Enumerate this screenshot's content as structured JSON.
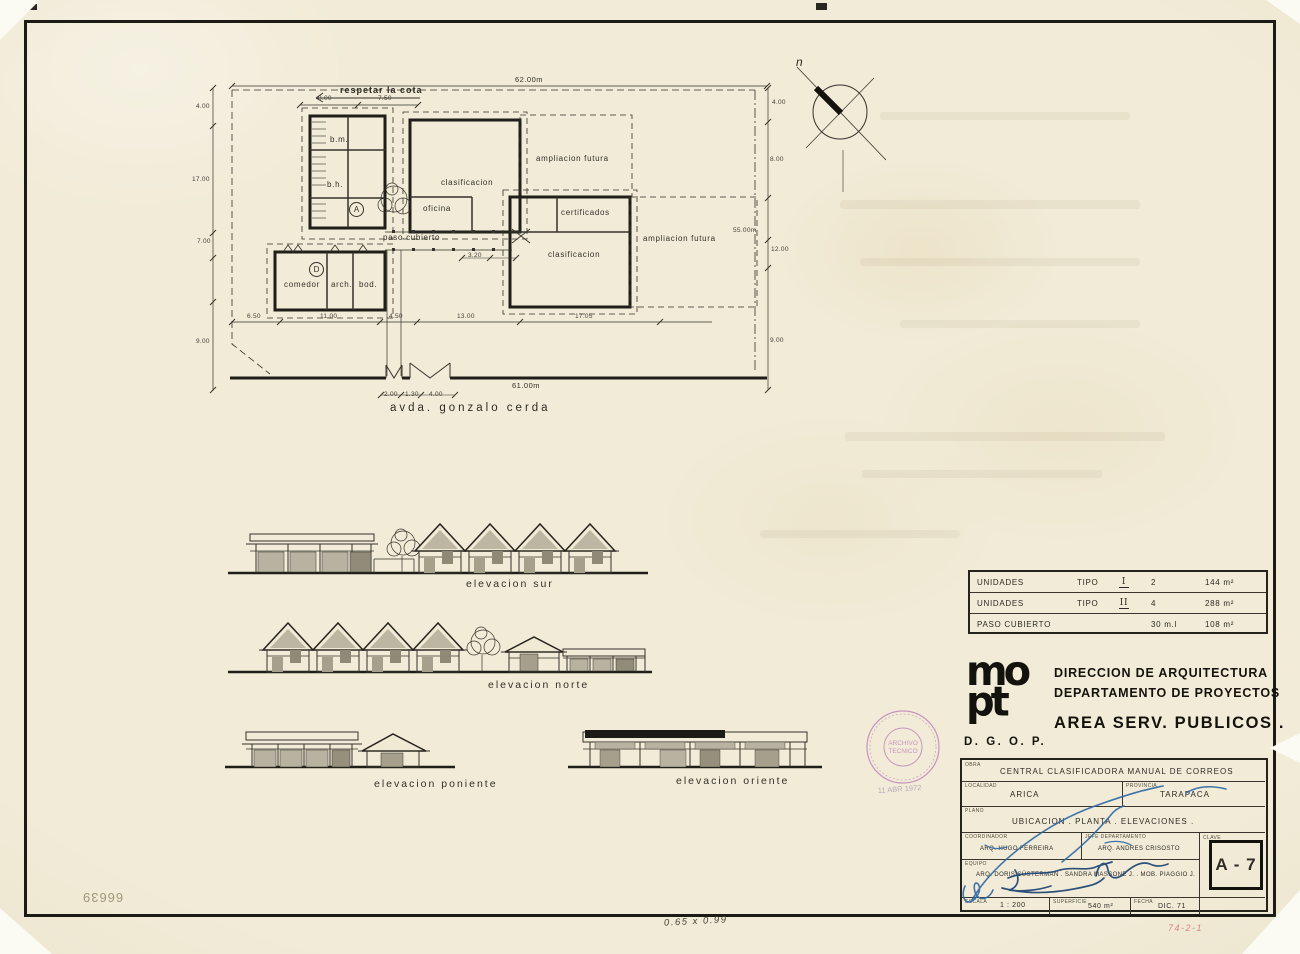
{
  "plan": {
    "labels": [
      {
        "text": "respetar la cota",
        "x": 340,
        "y": 85,
        "cls": "note"
      },
      {
        "text": "b.m.",
        "x": 330,
        "y": 135
      },
      {
        "text": "b.h.",
        "x": 327,
        "y": 180
      },
      {
        "text": "A",
        "x": 349,
        "y": 202,
        "cls": "circ"
      },
      {
        "text": "D",
        "x": 309,
        "y": 262,
        "cls": "circ"
      },
      {
        "text": "comedor",
        "x": 284,
        "y": 280
      },
      {
        "text": "arch.",
        "x": 331,
        "y": 280
      },
      {
        "text": "bod.",
        "x": 359,
        "y": 280
      },
      {
        "text": "clasificacion",
        "x": 441,
        "y": 178
      },
      {
        "text": "oficina",
        "x": 423,
        "y": 204
      },
      {
        "text": "certificados",
        "x": 561,
        "y": 208
      },
      {
        "text": "clasificacion",
        "x": 548,
        "y": 250
      },
      {
        "text": "ampliacion futura",
        "x": 536,
        "y": 154
      },
      {
        "text": "ampliacion futura",
        "x": 643,
        "y": 234
      },
      {
        "text": "paso cubierto",
        "x": 383,
        "y": 233
      },
      {
        "text": "avda.  gonzalo  cerda",
        "x": 390,
        "y": 402,
        "cls": "street"
      }
    ],
    "dims": [
      {
        "text": "62.00m",
        "x": 515,
        "y": 75,
        "cls": "dim"
      },
      {
        "text": "61.00m",
        "x": 512,
        "y": 381,
        "cls": "dim"
      },
      {
        "text": "8.00",
        "x": 318,
        "y": 95,
        "cls": "tiny"
      },
      {
        "text": "7.50",
        "x": 378,
        "y": 95,
        "cls": "tiny"
      },
      {
        "text": "4.00",
        "x": 196,
        "y": 103,
        "cls": "tiny"
      },
      {
        "text": "17.00",
        "x": 192,
        "y": 176,
        "cls": "tiny"
      },
      {
        "text": "7.00",
        "x": 197,
        "y": 238,
        "cls": "tiny"
      },
      {
        "text": "9.00",
        "x": 196,
        "y": 338,
        "cls": "tiny"
      },
      {
        "text": "4.00",
        "x": 772,
        "y": 99,
        "cls": "tiny"
      },
      {
        "text": "8.00",
        "x": 770,
        "y": 156,
        "cls": "tiny"
      },
      {
        "text": "55.00m",
        "x": 733,
        "y": 227,
        "cls": "tiny"
      },
      {
        "text": "12.00",
        "x": 771,
        "y": 246,
        "cls": "tiny"
      },
      {
        "text": "9.00",
        "x": 770,
        "y": 337,
        "cls": "tiny"
      },
      {
        "text": "6.50",
        "x": 247,
        "y": 313,
        "cls": "tiny"
      },
      {
        "text": "11.00",
        "x": 320,
        "y": 313,
        "cls": "tiny"
      },
      {
        "text": "4.50",
        "x": 389,
        "y": 313,
        "cls": "tiny"
      },
      {
        "text": "13.00",
        "x": 457,
        "y": 313,
        "cls": "tiny"
      },
      {
        "text": "17.05",
        "x": 575,
        "y": 313,
        "cls": "tiny"
      },
      {
        "text": "2.00",
        "x": 384,
        "y": 391,
        "cls": "tiny"
      },
      {
        "text": "1.30",
        "x": 405,
        "y": 391,
        "cls": "tiny"
      },
      {
        "text": "4.00",
        "x": 429,
        "y": 391,
        "cls": "tiny"
      },
      {
        "text": "3.20",
        "x": 468,
        "y": 252,
        "cls": "tiny"
      }
    ]
  },
  "compass": {
    "label": "n"
  },
  "elevations": {
    "captions": [
      {
        "text": "elevacion   sur",
        "x": 466,
        "y": 578,
        "cls": "cap"
      },
      {
        "text": "elevacion   norte",
        "x": 488,
        "y": 679,
        "cls": "cap"
      },
      {
        "text": "elevacion   poniente",
        "x": 374,
        "y": 778,
        "cls": "cap"
      },
      {
        "text": "elevacion  oriente",
        "x": 676,
        "y": 775,
        "cls": "cap"
      }
    ]
  },
  "units_table": {
    "rows": [
      {
        "label": "UNIDADES",
        "tipo": "TIPO",
        "roman": "I",
        "qty": "2",
        "area": "144 m²"
      },
      {
        "label": "UNIDADES",
        "tipo": "TIPO",
        "roman": "II",
        "qty": "4",
        "area": "288 m²"
      },
      {
        "label": "PASO  CUBIERTO",
        "tipo": "",
        "roman": "",
        "qty": "30 m.l",
        "area": "108 m²"
      }
    ]
  },
  "agency": {
    "logo_line1": "mo",
    "logo_line2": "pt",
    "org": "D. G. O. P.",
    "line1": "DIRECCION  DE  ARQUITECTURA",
    "line2": "DEPARTAMENTO  DE  PROYECTOS",
    "line3": "AREA  SERV.  PUBLICOS ."
  },
  "title_block": {
    "obra_label": "OBRA",
    "obra": "CENTRAL   CLASIFICADORA   MANUAL   DE   CORREOS",
    "localidad_label": "LOCALIDAD",
    "localidad": "ARICA",
    "provincia_label": "PROVINCIA",
    "provincia": "TARAPACA",
    "plano_label": "PLANO",
    "plano": "UBICACION .  PLANTA .  ELEVACIONES .",
    "coordinador_label": "COORDINADOR",
    "coordinador": "ARQ. HUGO FERREIRA",
    "jefe_label": "JEFE  DEPARTAMENTO",
    "jefe": "ARQ. ANDRES CRISOSTO",
    "equipo_label": "EQUIPO",
    "equipo": "ARQ. DORIS SÜSTERMAN .  SANDRA MASSONE J. .  MOB. PIAGGIO J.",
    "clave_label": "CLAVE",
    "clave": "A - 7",
    "escala_label": "ESCALA",
    "escala": "1 : 200",
    "superficie_label": "SUPERFICIE",
    "superficie": "540 m²",
    "fecha_label": "FECHA",
    "fecha": "DIC. 71"
  },
  "stamp": {
    "line1": "ARCHIVO",
    "line2": "TECNICO",
    "date": "11 ABR 1972"
  },
  "annotations": {
    "pencil_number": "66639",
    "size_note": "0.65 x 0.99",
    "red_code": "74-2-1"
  },
  "colors": {
    "paper": "#f0e9d4",
    "ink": "#35322b",
    "wall": "#211e19",
    "pen_blue": "#2d67a5",
    "stamp_purple": "#a44fae",
    "red_pencil": "#d2737d"
  }
}
